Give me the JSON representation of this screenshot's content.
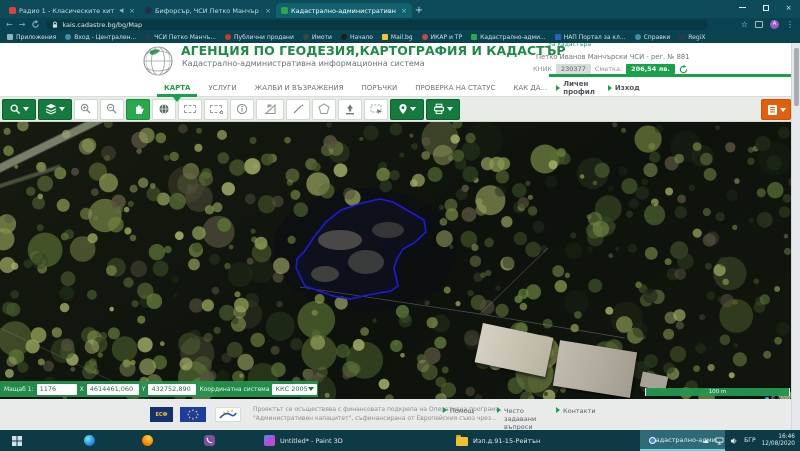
{
  "browser": {
    "tabs": [
      {
        "title": "Радио 1 - Класическите хит"
      },
      {
        "title": "Бифорсър, ЧСИ Петко Манчър"
      },
      {
        "title": "Кадастрално-административн"
      }
    ],
    "new_tab": "+",
    "close_glyph": "×",
    "back": "←",
    "forward": "→",
    "url": "kais.cadastre.bg/bg/Map",
    "star": "☆",
    "menu_dots": "⋮",
    "avatar_letter": "А"
  },
  "bookmarks": [
    "Приложения",
    "Вход - Централен...",
    "ЧСИ Петко Манчъ...",
    "Публични продани",
    "Имоти",
    "Начало",
    "Mail.bg",
    "ИКАР и ТР",
    "Кадастрално-адми...",
    "НАП Портал за кл...",
    "Справки",
    "RegiX"
  ],
  "header": {
    "title": "АГЕНЦИЯ ПО ГЕОДЕЗИЯ,КАРТОГРАФИЯ И КАДАСТЪР",
    "subtitle": "Кадастрално-административна информационна система",
    "top_link": "За кадастъра",
    "user": {
      "name": "Петко Иванов Манчърски ЧСИ - рег. № 881",
      "knik_label": "КНИК",
      "knik_value": "230377",
      "account_label": "Сметка:",
      "account_value": "206,54 лв.",
      "profile_link": "Личен профил",
      "logout_link": "Изход"
    }
  },
  "nav": {
    "items": [
      "КАРТА",
      "УСЛУГИ",
      "ЖАЛБИ И ВЪЗРАЖЕНИЯ",
      "ПОРЪЧКИ",
      "ПРОВЕРКА НА СТАТУС",
      "КАК ДА..."
    ]
  },
  "toolbar": {
    "icons": [
      "search",
      "layers",
      "zoom-in",
      "zoom-out",
      "pan-hand",
      "overview-globe",
      "select-rectangle",
      "select-extent",
      "identify-info",
      "measure-area",
      "measure-distance",
      "draw-polygon",
      "import-upload",
      "select-region",
      "locate-marker",
      "print",
      "reports-menu"
    ]
  },
  "map": {
    "statusbar": {
      "scale_label": "Мащаб 1:",
      "scale_value": "1176",
      "x_label": "X",
      "x_value": "4614461,060",
      "y_label": "Y",
      "y_value": "432752,890",
      "crs_label": "Координатна система",
      "crs_value": "ККС 2005"
    },
    "scalebar_label": "100 m",
    "attribution": "© 2020",
    "polygon_points": "393,80 412,91 424,98 426,110 414,121 403,127 397,137 394,146 398,164 391,169 368,173 350,177 333,174 305,164 296,146 297,137 304,130 314,115 326,100 341,88 362,81 380,77"
  },
  "footer": {
    "text_line1": "Проектът се осъществява с финансовата подкрепа на Оперативна програма",
    "text_line2": "\"Административен капацитет\", съфинансирана от Европейския съюз чрез...",
    "links": [
      "Помощ",
      "Често задавани въпроси",
      "Контакти"
    ],
    "logo1_text": "ЕСФ"
  },
  "taskbar": {
    "apps": [
      {
        "label": "Untitled* - Paint 3D"
      },
      {
        "label": "Изп.д.91-15-Рейтън"
      },
      {
        "label": "Кадастрално-адми..."
      }
    ],
    "tray": {
      "lang": "БГР",
      "time": "16:46",
      "date": "12/08/2020"
    }
  }
}
